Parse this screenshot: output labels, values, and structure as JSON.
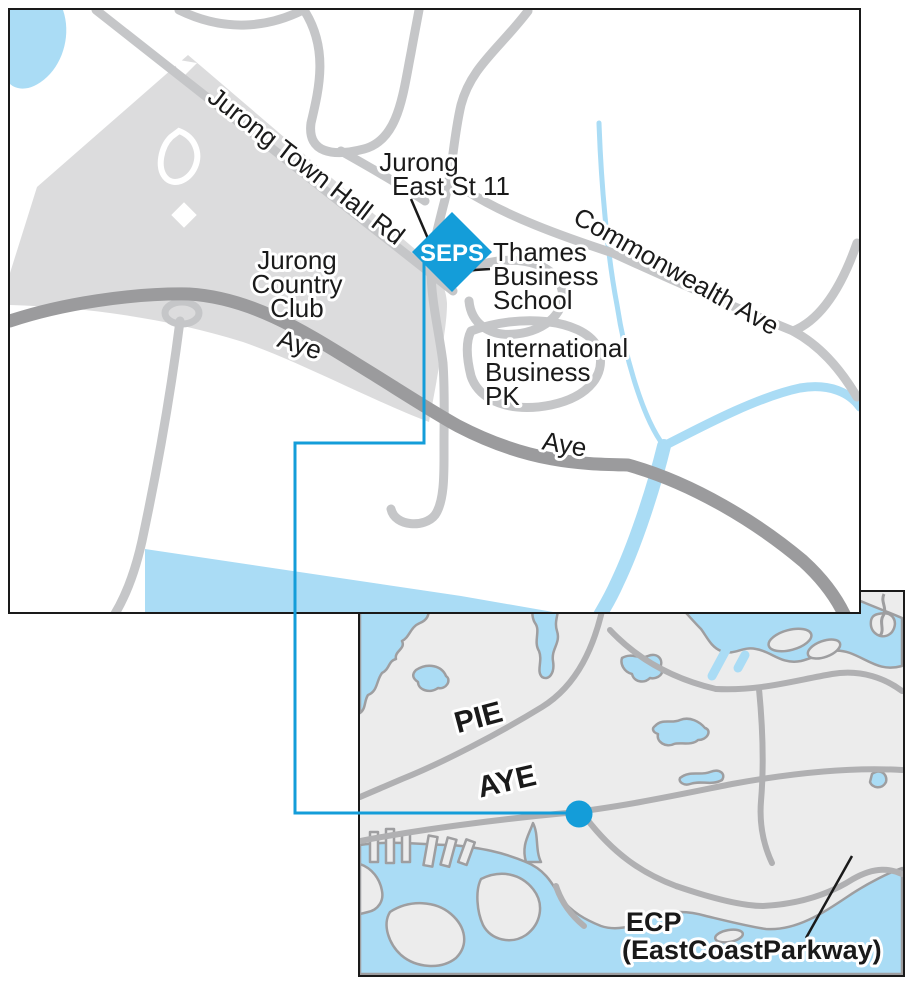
{
  "main_map": {
    "road_labels": {
      "jurong_town_hall_rd": "Jurong Town Hall Rd",
      "commonwealth_ave": "Commonwealth Ave",
      "aye_west": "Aye",
      "aye_east": "Aye"
    },
    "place_labels": {
      "jurong_east_st11": [
        "Jurong",
        "East St 11"
      ],
      "jurong_country_club": [
        "Jurong",
        "Country",
        "Club"
      ],
      "thames_business_school": [
        "Thames",
        "Business",
        "School"
      ],
      "international_business_pk": [
        "International",
        "Business",
        "PK"
      ]
    },
    "marker": {
      "label": "SEPS"
    }
  },
  "inset_map": {
    "expressway_labels": {
      "pie": "PIE",
      "aye": "AYE"
    },
    "ecp_label": [
      "ECP",
      "(EastCoastParkway)"
    ]
  },
  "colors": {
    "marker_blue": "#149dd9",
    "leader_blue": "#149dd9",
    "water_blue": "#aadcf5",
    "road_gray": "#c5c6c8",
    "highway_gray": "#9b9b9d",
    "land_gray": "#ececec",
    "club_gray": "#dcdcdd",
    "coast_gray": "#9e9ea0",
    "border_black": "#1a1a1a"
  }
}
